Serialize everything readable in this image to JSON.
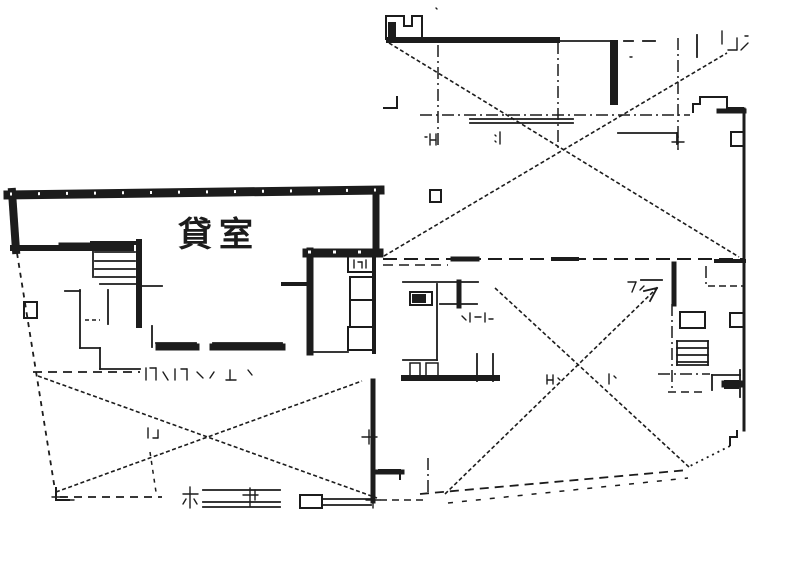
{
  "document": {
    "type": "architectural-floor-plan-scan",
    "background": "#ffffff",
    "ink": "#1c1c1c",
    "label": {
      "text": "貸室",
      "x": 178,
      "y": 246,
      "font_size": 34,
      "letter_spacing": 7
    }
  },
  "floorplan": {
    "width": 787,
    "height": 581,
    "thick_walls": [
      [
        8,
        195,
        380,
        190,
        9
      ],
      [
        12,
        192,
        16,
        250,
        8
      ],
      [
        13,
        248,
        131,
        248,
        6
      ],
      [
        376,
        190,
        376,
        253,
        7
      ],
      [
        307,
        253,
        379,
        253,
        9
      ],
      [
        310,
        251,
        310,
        352,
        7
      ],
      [
        139,
        242,
        139,
        325,
        6
      ],
      [
        159,
        347,
        196,
        347,
        7
      ],
      [
        213,
        347,
        250,
        347,
        7
      ],
      [
        253,
        347,
        282,
        347,
        7
      ],
      [
        373,
        381,
        373,
        501,
        5
      ],
      [
        614,
        44,
        614,
        101,
        8
      ],
      [
        719,
        111,
        744,
        111,
        5
      ],
      [
        744,
        109,
        744,
        430,
        3
      ],
      [
        389,
        40,
        557,
        40,
        6
      ],
      [
        404,
        378,
        497,
        378,
        6
      ],
      [
        459,
        282,
        459,
        306,
        5
      ],
      [
        374,
        252,
        374,
        352,
        4
      ],
      [
        378,
        472,
        402,
        472,
        5
      ],
      [
        283,
        284,
        309,
        284,
        4
      ],
      [
        453,
        259,
        477,
        259,
        5
      ],
      [
        553,
        259,
        577,
        259,
        4
      ],
      [
        674,
        264,
        674,
        304,
        5
      ],
      [
        716,
        261,
        744,
        261,
        4
      ],
      [
        92,
        243,
        137,
        243,
        4
      ],
      [
        60,
        244,
        90,
        244,
        3
      ],
      [
        725,
        384,
        740,
        384,
        7
      ]
    ],
    "thin_walls": [
      [
        95,
        252,
        135,
        252
      ],
      [
        95,
        261,
        135,
        261
      ],
      [
        95,
        269,
        135,
        269
      ],
      [
        93,
        244,
        93,
        277
      ],
      [
        95,
        277,
        135,
        277
      ],
      [
        80,
        290,
        80,
        348
      ],
      [
        80,
        348,
        100,
        348
      ],
      [
        100,
        348,
        100,
        369
      ],
      [
        100,
        369,
        140,
        369
      ],
      [
        65,
        291,
        80,
        291
      ],
      [
        100,
        284,
        140,
        284
      ],
      [
        108,
        290,
        108,
        324
      ],
      [
        140,
        286,
        162,
        286
      ],
      [
        152,
        326,
        152,
        347
      ],
      [
        156,
        343,
        196,
        343
      ],
      [
        213,
        343,
        282,
        343
      ],
      [
        310,
        352,
        348,
        352
      ],
      [
        403,
        282,
        457,
        282
      ],
      [
        461,
        282,
        478,
        282
      ],
      [
        437,
        284,
        437,
        360
      ],
      [
        440,
        304,
        477,
        304
      ],
      [
        403,
        360,
        437,
        360
      ],
      [
        477,
        354,
        477,
        381
      ],
      [
        493,
        354,
        493,
        381
      ],
      [
        470,
        119,
        573,
        119
      ],
      [
        470,
        123,
        573,
        123
      ],
      [
        618,
        133,
        677,
        133
      ],
      [
        677,
        133,
        677,
        144
      ],
      [
        557,
        41,
        612,
        41
      ],
      [
        612,
        41,
        612,
        57
      ],
      [
        697,
        35,
        697,
        57
      ],
      [
        624,
        41,
        633,
        41
      ],
      [
        643,
        41,
        655,
        41
      ],
      [
        677,
        341,
        708,
        341
      ],
      [
        677,
        348,
        708,
        348
      ],
      [
        677,
        355,
        708,
        355
      ],
      [
        677,
        362,
        708,
        362
      ],
      [
        677,
        341,
        677,
        365
      ],
      [
        708,
        341,
        708,
        365
      ],
      [
        677,
        365,
        708,
        365
      ],
      [
        203,
        490,
        280,
        490
      ],
      [
        203,
        502,
        280,
        502
      ],
      [
        203,
        507,
        280,
        507
      ],
      [
        322,
        499,
        371,
        499
      ],
      [
        322,
        505,
        371,
        505
      ],
      [
        657,
        288,
        644,
        291
      ],
      [
        657,
        288,
        650,
        301
      ],
      [
        641,
        280,
        662,
        280
      ],
      [
        712,
        375,
        740,
        375
      ],
      [
        712,
        375,
        712,
        390
      ],
      [
        740,
        370,
        740,
        397
      ]
    ],
    "polylines": [
      [
        [
          386,
          40
        ],
        [
          386,
          16
        ],
        [
          404,
          16
        ],
        [
          404,
          26
        ],
        [
          412,
          26
        ],
        [
          412,
          16
        ],
        [
          422,
          16
        ],
        [
          422,
          40
        ]
      ],
      [
        [
          693,
          113
        ],
        [
          693,
          104
        ],
        [
          700,
          104
        ],
        [
          700,
          97
        ],
        [
          727,
          97
        ],
        [
          727,
          108
        ],
        [
          744,
          108
        ]
      ],
      [
        [
          744,
          132
        ],
        [
          731,
          132
        ],
        [
          731,
          146
        ],
        [
          744,
          146
        ]
      ],
      [
        [
          737,
          430
        ],
        [
          737,
          437
        ],
        [
          730,
          437
        ],
        [
          730,
          446
        ]
      ],
      [
        [
          383,
          108
        ],
        [
          397,
          108
        ],
        [
          397,
          96
        ]
      ],
      [
        [
          378,
          470
        ],
        [
          400,
          470
        ],
        [
          400,
          480
        ]
      ],
      [
        [
          56,
          487
        ],
        [
          56,
          500
        ],
        [
          70,
          500
        ]
      ]
    ],
    "rects": [
      [
        348,
        256,
        26,
        16,
        2
      ],
      [
        350,
        277,
        24,
        23,
        2
      ],
      [
        350,
        300,
        24,
        27,
        2
      ],
      [
        348,
        327,
        26,
        23,
        2
      ],
      [
        410,
        292,
        22,
        13,
        2
      ],
      [
        430,
        190,
        11,
        12,
        2
      ],
      [
        730,
        313,
        14,
        14,
        2
      ],
      [
        300,
        495,
        22,
        13,
        2
      ],
      [
        24,
        302,
        13,
        16,
        2
      ],
      [
        410,
        363,
        10,
        14,
        1.5
      ],
      [
        426,
        363,
        12,
        14,
        1.5
      ],
      [
        680,
        312,
        25,
        16,
        2
      ]
    ],
    "filled_rects": [
      [
        412,
        294,
        14,
        9
      ],
      [
        724,
        380,
        15,
        9
      ],
      [
        388,
        22,
        8,
        18
      ]
    ],
    "dashed": [
      [
        17,
        253,
        55,
        490,
        "5,5",
        1.8
      ],
      [
        60,
        497,
        162,
        497,
        "8,6",
        1.8
      ],
      [
        420,
        494,
        688,
        470,
        "9,6",
        1.8
      ],
      [
        730,
        446,
        690,
        466,
        "2,4",
        1.8
      ],
      [
        383,
        259,
        745,
        259,
        "14,7",
        2
      ],
      [
        383,
        265,
        448,
        265,
        "10,6",
        1.5
      ],
      [
        33,
        372,
        140,
        372,
        "9,6",
        1.8
      ],
      [
        380,
        500,
        425,
        500,
        "7,5",
        1.5
      ],
      [
        448,
        503,
        688,
        478,
        "5,9",
        1.5
      ],
      [
        150,
        452,
        156,
        492,
        "4,5",
        1.5
      ],
      [
        85,
        320,
        100,
        320,
        "4,3",
        1.5
      ],
      [
        708,
        286,
        744,
        286,
        "7,4",
        1.5
      ],
      [
        668,
        392,
        704,
        392,
        "8,5",
        1.5
      ],
      [
        10,
        194,
        378,
        190,
        "2,26",
        3,
        "#ffffff"
      ],
      [
        308,
        252,
        378,
        252,
        "3,22",
        3,
        "#ffffff"
      ]
    ],
    "dashdot": [
      [
        438,
        45,
        438,
        148
      ],
      [
        558,
        42,
        558,
        152
      ],
      [
        678,
        38,
        678,
        150
      ],
      [
        420,
        115,
        690,
        115
      ],
      [
        672,
        304,
        672,
        392
      ],
      [
        658,
        374,
        710,
        374
      ],
      [
        428,
        458,
        428,
        492
      ],
      [
        706,
        266,
        706,
        288
      ]
    ],
    "diagonals": [
      [
        389,
        43,
        739,
        257
      ],
      [
        384,
        256,
        727,
        53
      ],
      [
        38,
        376,
        377,
        498
      ],
      [
        56,
        492,
        362,
        381
      ],
      [
        495,
        288,
        689,
        467
      ],
      [
        445,
        494,
        656,
        289
      ]
    ],
    "scribbles": [
      [
        146,
        368,
        146,
        380
      ],
      [
        150,
        368,
        156,
        368
      ],
      [
        156,
        368,
        156,
        380
      ],
      [
        163,
        372,
        168,
        380
      ],
      [
        175,
        369,
        175,
        380
      ],
      [
        181,
        369,
        187,
        369
      ],
      [
        187,
        369,
        187,
        380
      ],
      [
        197,
        372,
        203,
        378
      ],
      [
        210,
        378,
        214,
        372
      ],
      [
        230,
        370,
        230,
        380
      ],
      [
        226,
        380,
        236,
        380
      ],
      [
        248,
        370,
        252,
        375
      ],
      [
        462,
        316,
        466,
        320
      ],
      [
        470,
        313,
        470,
        322
      ],
      [
        475,
        317,
        481,
        317
      ],
      [
        485,
        313,
        485,
        322
      ],
      [
        489,
        319,
        493,
        319
      ],
      [
        547,
        375,
        547,
        384
      ],
      [
        553,
        375,
        553,
        384
      ],
      [
        547,
        380,
        553,
        380
      ],
      [
        558,
        378,
        560,
        380
      ],
      [
        609,
        374,
        609,
        384
      ],
      [
        614,
        376,
        616,
        378
      ],
      [
        628,
        282,
        636,
        282
      ],
      [
        636,
        282,
        632,
        292
      ],
      [
        640,
        290,
        644,
        286
      ],
      [
        722,
        31,
        722,
        44
      ],
      [
        728,
        50,
        737,
        50
      ],
      [
        737,
        50,
        737,
        38
      ],
      [
        741,
        50,
        748,
        43
      ],
      [
        745,
        36,
        748,
        36
      ],
      [
        430,
        134,
        430,
        145
      ],
      [
        436,
        134,
        436,
        145
      ],
      [
        431,
        140,
        436,
        140
      ],
      [
        425,
        137,
        427,
        137
      ],
      [
        500,
        132,
        500,
        144
      ],
      [
        495,
        135,
        496,
        136
      ],
      [
        495,
        141,
        496,
        142
      ],
      [
        672,
        142,
        684,
        142
      ],
      [
        678,
        136,
        678,
        148
      ],
      [
        362,
        437,
        377,
        437
      ],
      [
        369,
        430,
        369,
        444
      ],
      [
        366,
        500,
        380,
        500
      ],
      [
        373,
        493,
        373,
        508
      ],
      [
        190,
        487,
        190,
        508
      ],
      [
        183,
        494,
        198,
        494
      ],
      [
        186,
        499,
        183,
        504
      ],
      [
        194,
        499,
        197,
        504
      ],
      [
        250,
        488,
        250,
        506
      ],
      [
        243,
        495,
        258,
        495
      ],
      [
        255,
        490,
        255,
        500
      ],
      [
        52,
        497,
        66,
        497
      ],
      [
        60,
        500,
        74,
        500
      ],
      [
        148,
        428,
        148,
        438
      ],
      [
        153,
        438,
        158,
        438
      ],
      [
        158,
        430,
        158,
        438
      ],
      [
        354,
        260,
        354,
        268
      ],
      [
        358,
        262,
        362,
        262
      ],
      [
        362,
        262,
        362,
        268
      ],
      [
        366,
        260,
        366,
        268
      ],
      [
        436,
        8,
        437,
        9
      ],
      [
        630,
        57,
        632,
        57
      ]
    ]
  }
}
